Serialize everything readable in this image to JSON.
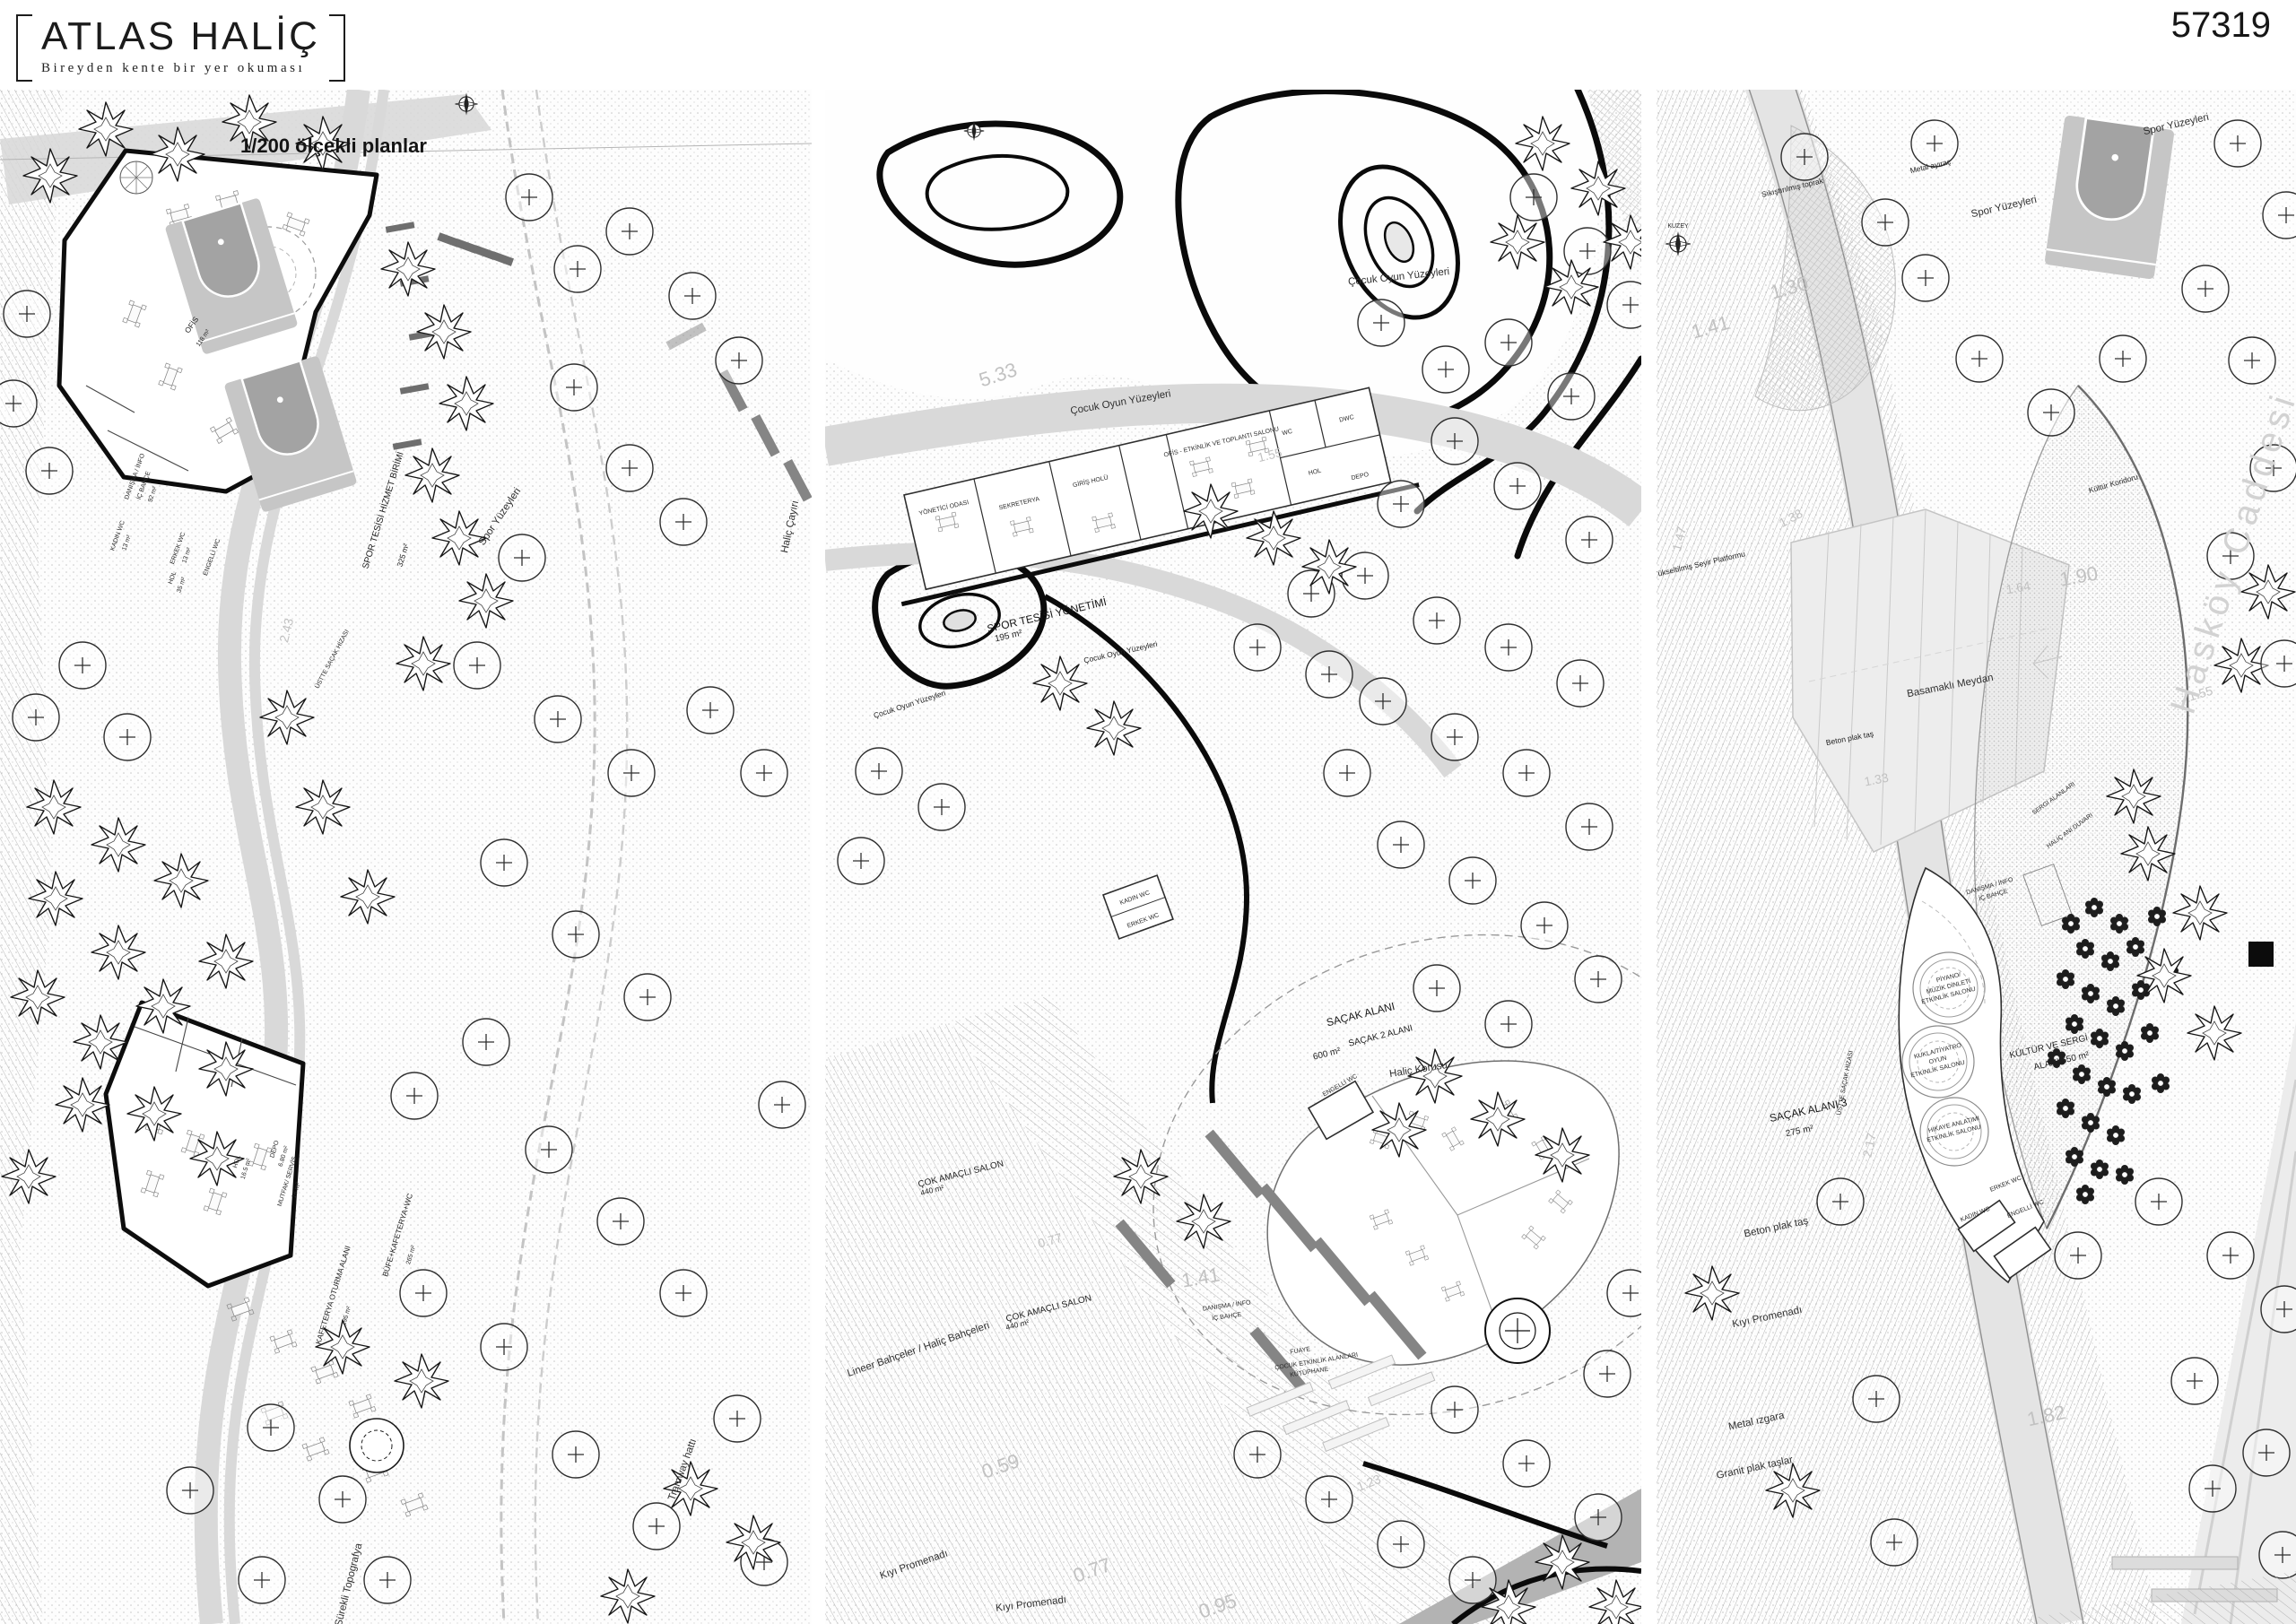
{
  "header": {
    "title": "ATLAS HALİÇ",
    "subtitle": "Bireyden kente bir yer okuması",
    "scale_label": "1/200 ölçekli planlar",
    "sheet_number": "57319"
  },
  "colors": {
    "ink": "#111111",
    "road_gray": "#d9d9d9",
    "court_fill": "#c6c6c6",
    "court_key": "#a3a3a3",
    "bench_gray": "#858585",
    "contour_gray": "#c2c2c2",
    "street_gray": "#d2d2d2"
  },
  "compass_label": "KUZEY",
  "panels": {
    "left": {
      "name": "1/200 plan — spor tesisi ve kafeterya",
      "labels": {
        "spor_tesisi": "SPOR TESİSİ HİZMET BİRİMİ",
        "spor_tesisi_area": "325 m²",
        "ofis": "OFİS",
        "ofis_area": "118 m²",
        "danisma": [
          "DANIŞMA / İNFO",
          "İÇ BAHÇE",
          "92 m²"
        ],
        "kadin_wc": "KADIN WC",
        "kadin_wc_area": "13 m²",
        "erkek_wc": "ERKEK WC",
        "erkek_wc_area": "13 m²",
        "engelli_wc": "ENGELLİ WC",
        "hol": "HOL",
        "hol_area": "35 m²",
        "sacak_hizasi": "ÜSTTE SAÇAK HİZASI",
        "spor_yuzeyleri": "Spor Yüzeyleri",
        "halic_cayiri": "Haliç Çayırı",
        "kafeterya": [
          "KAFETERYA OTURMA ALANI",
          "195 m²"
        ],
        "bufe": [
          "BÜFE+KAFETERYA+WC",
          "265 m²"
        ],
        "mutfak": [
          "MUTFAK/ SERVİS",
          "16 m²"
        ],
        "hol2": [
          "HOL",
          "16.5 m²"
        ],
        "depo": [
          "DEPO",
          "6.80 m²"
        ],
        "surekli": "Sürekli Topografya",
        "tramway": "Tramway hattı",
        "c243": "2.43"
      }
    },
    "middle": {
      "name": "1/200 plan — çocuk oyun alanı ve çok amaçlı salon",
      "labels": {
        "cocuk_oyun": "Çocuk Oyun Yüzeyleri",
        "c533": "5.33",
        "yonetici": "YÖNETİCİ ODASI",
        "sekreterya": "SEKRETERYA",
        "giris_holu": "GİRİŞ HOLÜ",
        "ofis_salon": "OFİS - ETKİNLİK VE TOPLANTI SALONU",
        "wc": "WC",
        "dwc": "DWC",
        "hol": "HOL",
        "depo": "DEPO",
        "spor_yonetimi": [
          "SPOR TESİSİ YÖNETİMİ",
          "195 m²"
        ],
        "c155": "1.55",
        "sacak": [
          "SAÇAK ALANI",
          "SAÇAK 2 ALANI",
          "600 m²"
        ],
        "halic_korusu": "Haliç Korusu",
        "cok_amacli": [
          "ÇOK AMAÇLI SALON",
          "440 m²"
        ],
        "engelli_wc": "ENGELLİ WC",
        "kadin_wc": "KADIN WC",
        "erkek_wc": "ERKEK WC",
        "danisma": [
          "DANIŞMA / İNFO",
          "İÇ BAHÇE"
        ],
        "fuaye": [
          "FUAYE",
          "ÇOCUK ETKİNLİK ALANLARI",
          "KÜTÜPHANE"
        ],
        "lineer": "Lineer Bahçeler / Haliç Bahçeleri",
        "kiyi": "Kıyı Promenadı",
        "c059": "0.59",
        "c077": "0.77",
        "c095": "0.95",
        "c141": "1.41",
        "c123": "1.23"
      }
    },
    "right": {
      "name": "1/200 plan — kültür ve sergi alanı",
      "labels": {
        "sikistirilmis": "Sıkıştırılmış toprak",
        "metal_ayirac": "Metal ayıraç",
        "spor_yuzeyleri": "Spor Yüzeyleri",
        "kultur_koridoru": "Kültür Koridoru",
        "yukseltilmis": "Yükseltilmiş Seyir Platformu",
        "basamakli": "Basamaklı Meydan",
        "beton_plak": "Beton plak taş",
        "c190": "1.90",
        "c138": "1.38",
        "c130": "1.30",
        "c141": "1.41",
        "c147": "1.47",
        "c164": "1.64",
        "c133": "1.33",
        "c155": "1.55",
        "c182": "1.82",
        "c217": "2.17",
        "danisma": [
          "DANIŞMA / İNFO",
          "İÇ BAHÇE"
        ],
        "piyano": [
          "PİYANO/",
          "MÜZİK DİNLETİ",
          "ETKİNLİK SALONU"
        ],
        "kukla": [
          "KUKLA/TİYATRO",
          "OYUN",
          "ETKİNLİK SALONU"
        ],
        "hikaye": [
          "HİKAYE ANLATIMI",
          "ETKİNLİK SALONU"
        ],
        "erkek_wc": "ERKEK WC",
        "kadin_wc": "KADIN WC",
        "engelli_wc": "ENGELLİ WC",
        "kultur_sergi": [
          "KÜLTÜR VE SERGİ",
          "ALANI 650 m²"
        ],
        "sergi": "SERGİ ALANLARI",
        "halic_ani": "HALİÇ ANI DUVARI",
        "haskoy": "Hasköy Caddesi",
        "sacak3": [
          "SAÇAK ALANI 3",
          "275 m²"
        ],
        "kiyi": "Kıyı Promenadı",
        "metal_izgara": "Metal ızgara",
        "granit": "Granit plak taşlar",
        "uste_sacak": "ÜSTTE SAÇAK HİZASI"
      }
    }
  }
}
